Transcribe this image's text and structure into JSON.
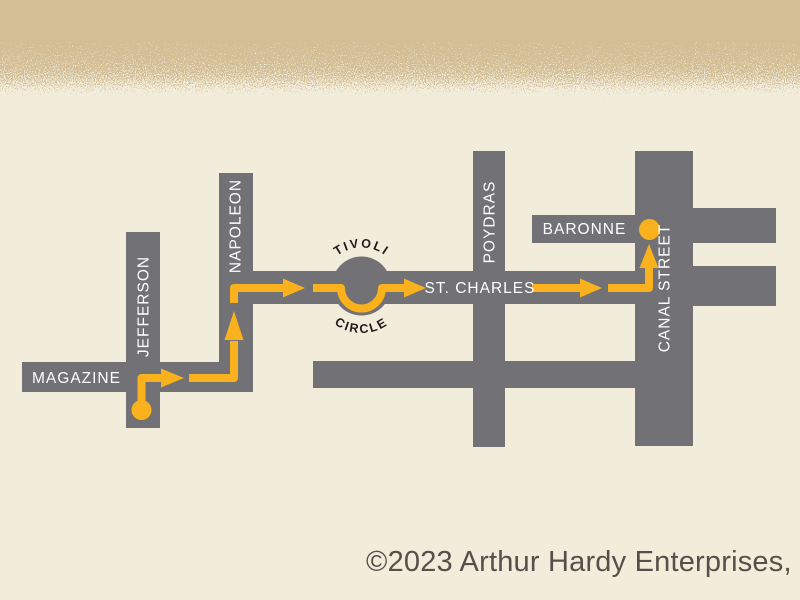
{
  "page": {
    "background": "#f2ecdb",
    "header_band_color": "#d3be96"
  },
  "map": {
    "streets": {
      "magazine": "MAGAZINE",
      "jefferson": "JEFFERSON",
      "napoleon": "NAPOLEON",
      "tivoli_line1": "TIVOLI",
      "tivoli_line2": "CIRCLE",
      "st_charles": "ST. CHARLES",
      "poydras": "POYDRAS",
      "baronne": "BARONNE",
      "canal": "CANAL STREET"
    },
    "colors": {
      "street": "#717176",
      "route": "#f9b11d",
      "street_label": "#ffffff",
      "circle_label": "#1d1c1a"
    }
  },
  "footer": {
    "copyright": "©2023 Arthur Hardy Enterprises,"
  }
}
